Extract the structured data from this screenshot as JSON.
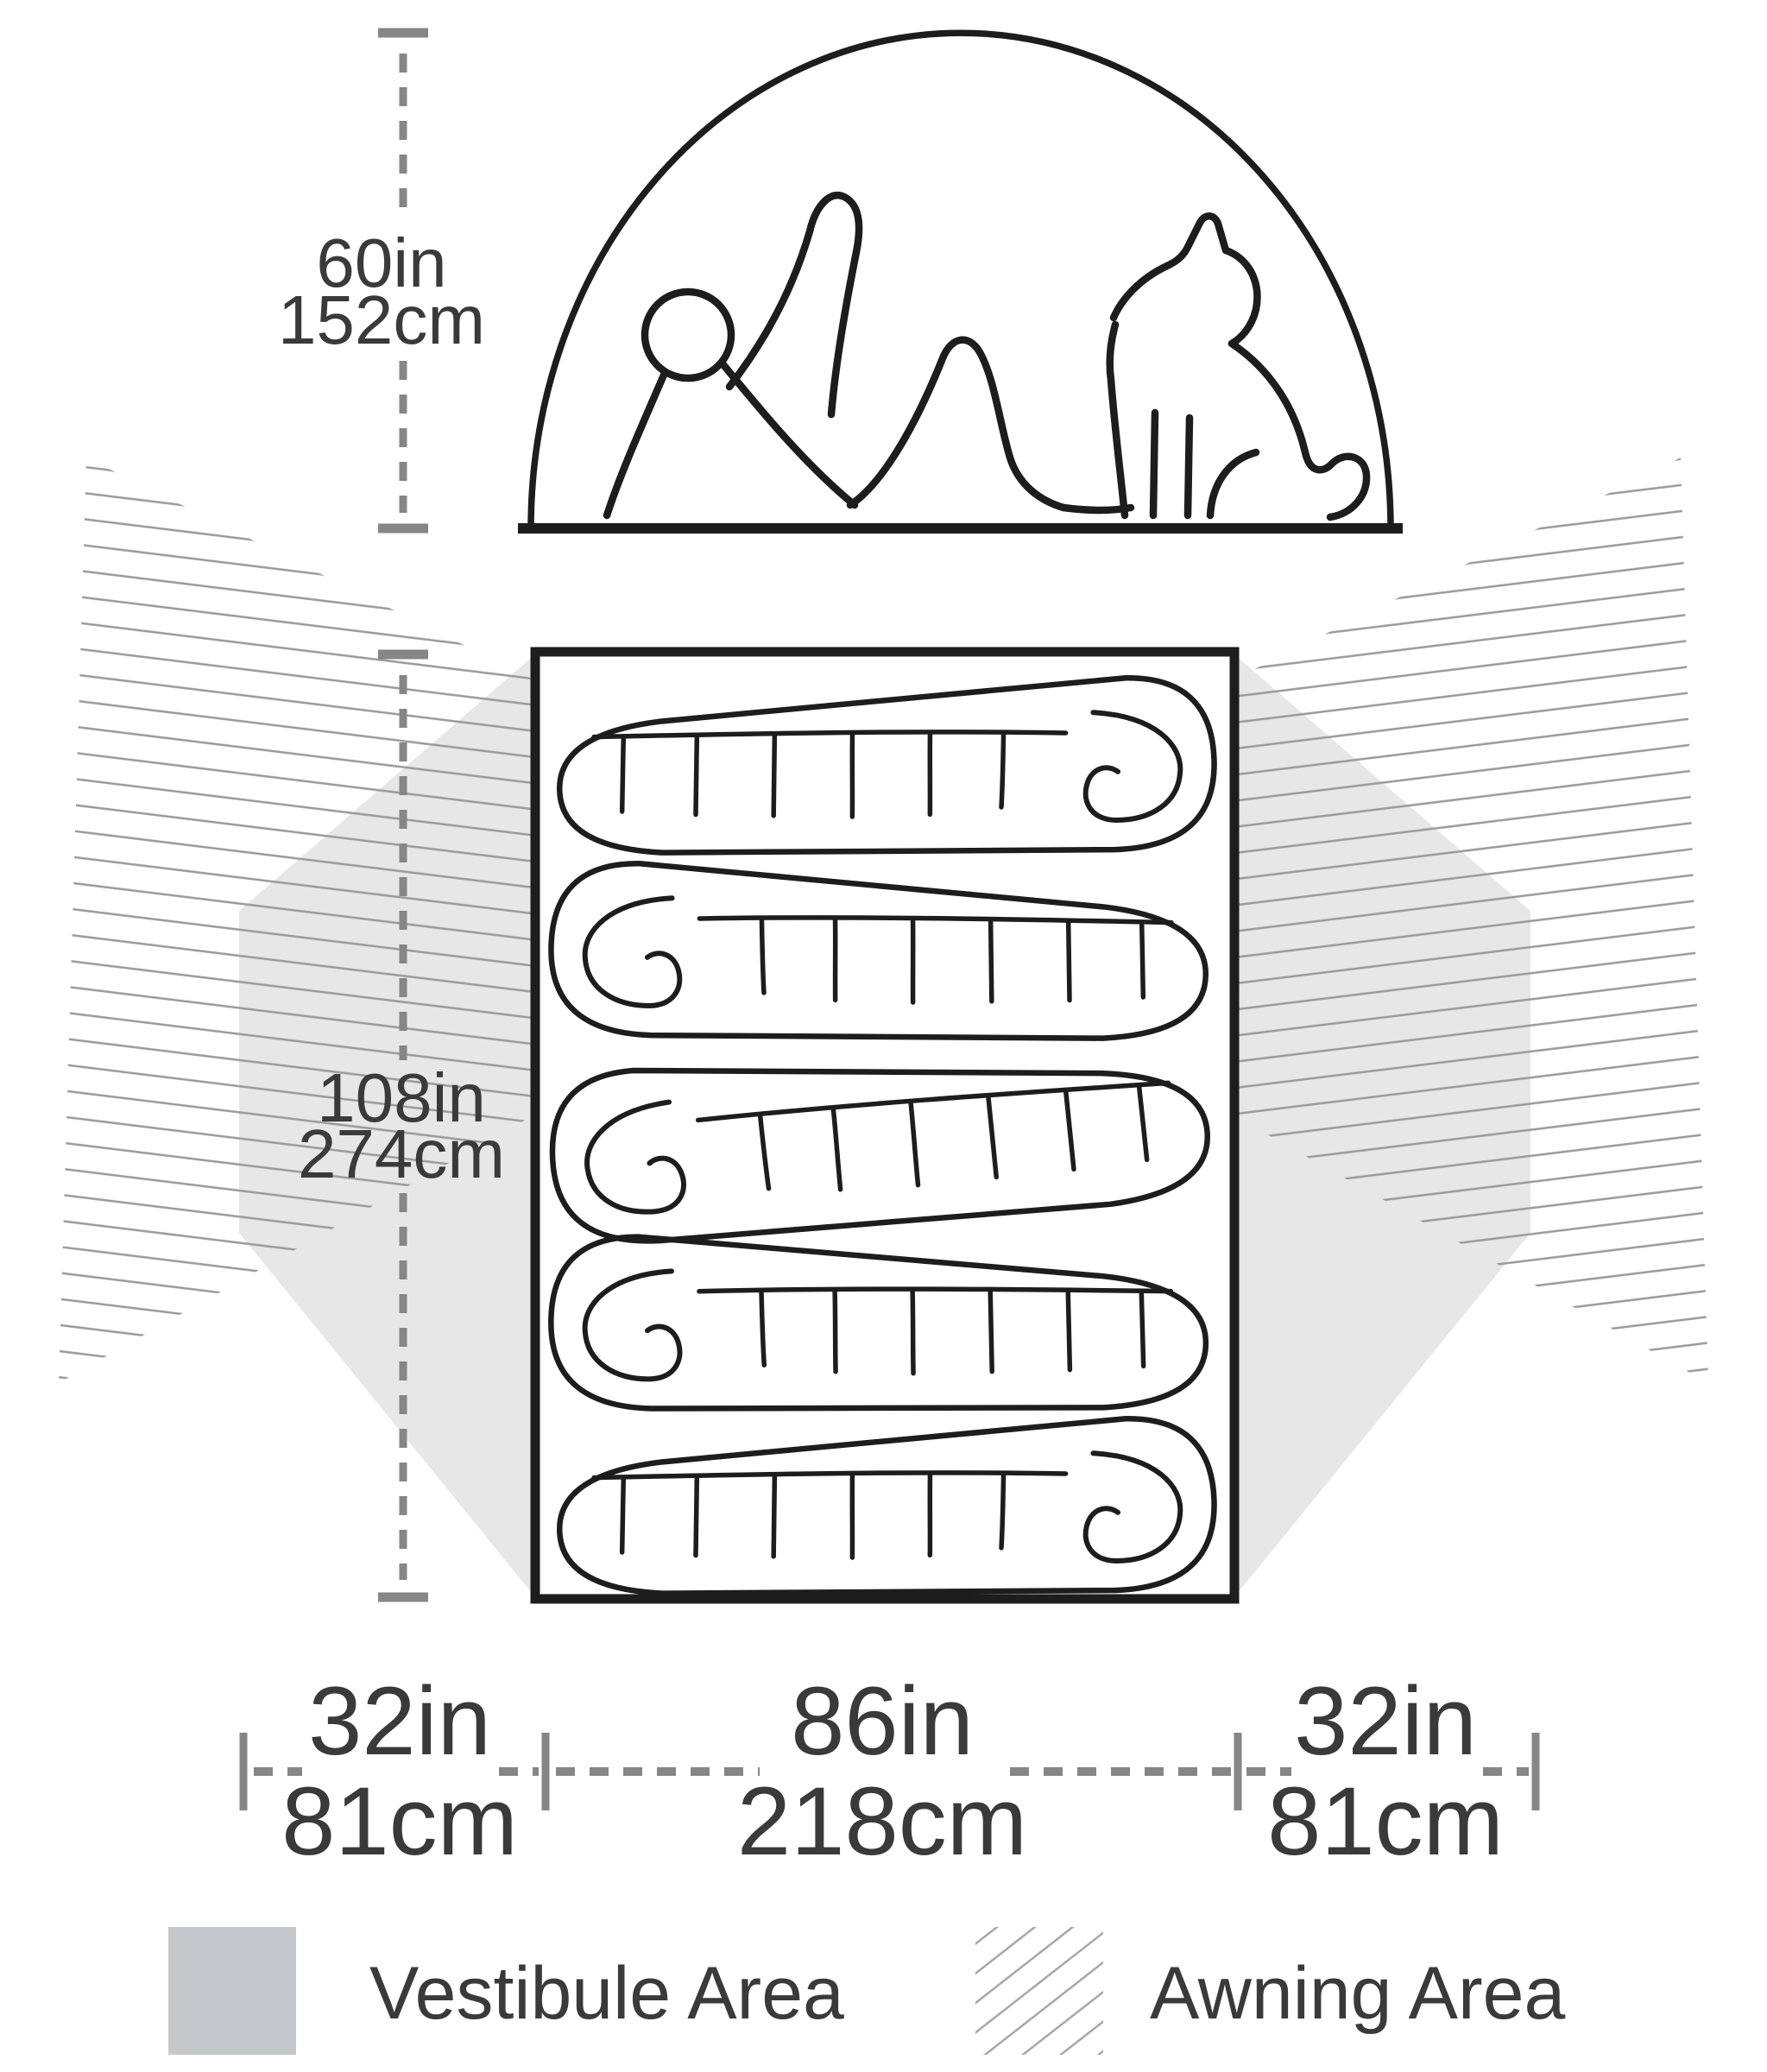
{
  "diagram": {
    "title": "Tent dimensions diagram",
    "side_view": {
      "height_label": {
        "in": "60in",
        "cm": "152cm"
      },
      "occupants": [
        "person",
        "dog"
      ]
    },
    "floor_plan": {
      "length_label": {
        "in": "108in",
        "cm": "274cm"
      },
      "width_labels": {
        "left": {
          "in": "32in",
          "cm": "81cm"
        },
        "center": {
          "in": "86in",
          "cm": "218cm"
        },
        "right": {
          "in": "32in",
          "cm": "81cm"
        }
      },
      "sleeping_bag_count": 5
    },
    "legend": [
      {
        "swatch": "vestibule",
        "label": "Vestibule Area"
      },
      {
        "swatch": "awning",
        "label": "Awning Area"
      }
    ],
    "colors": {
      "line_ink": "#1d1d1d",
      "measure_gray": "#868686",
      "text_gray": "#3a3a3a",
      "vestibule_area_fill": "#e7e7e7",
      "vestibule_legend_fill": "#c5c9cc",
      "awning_hatch_line": "#9a9a9a"
    }
  }
}
